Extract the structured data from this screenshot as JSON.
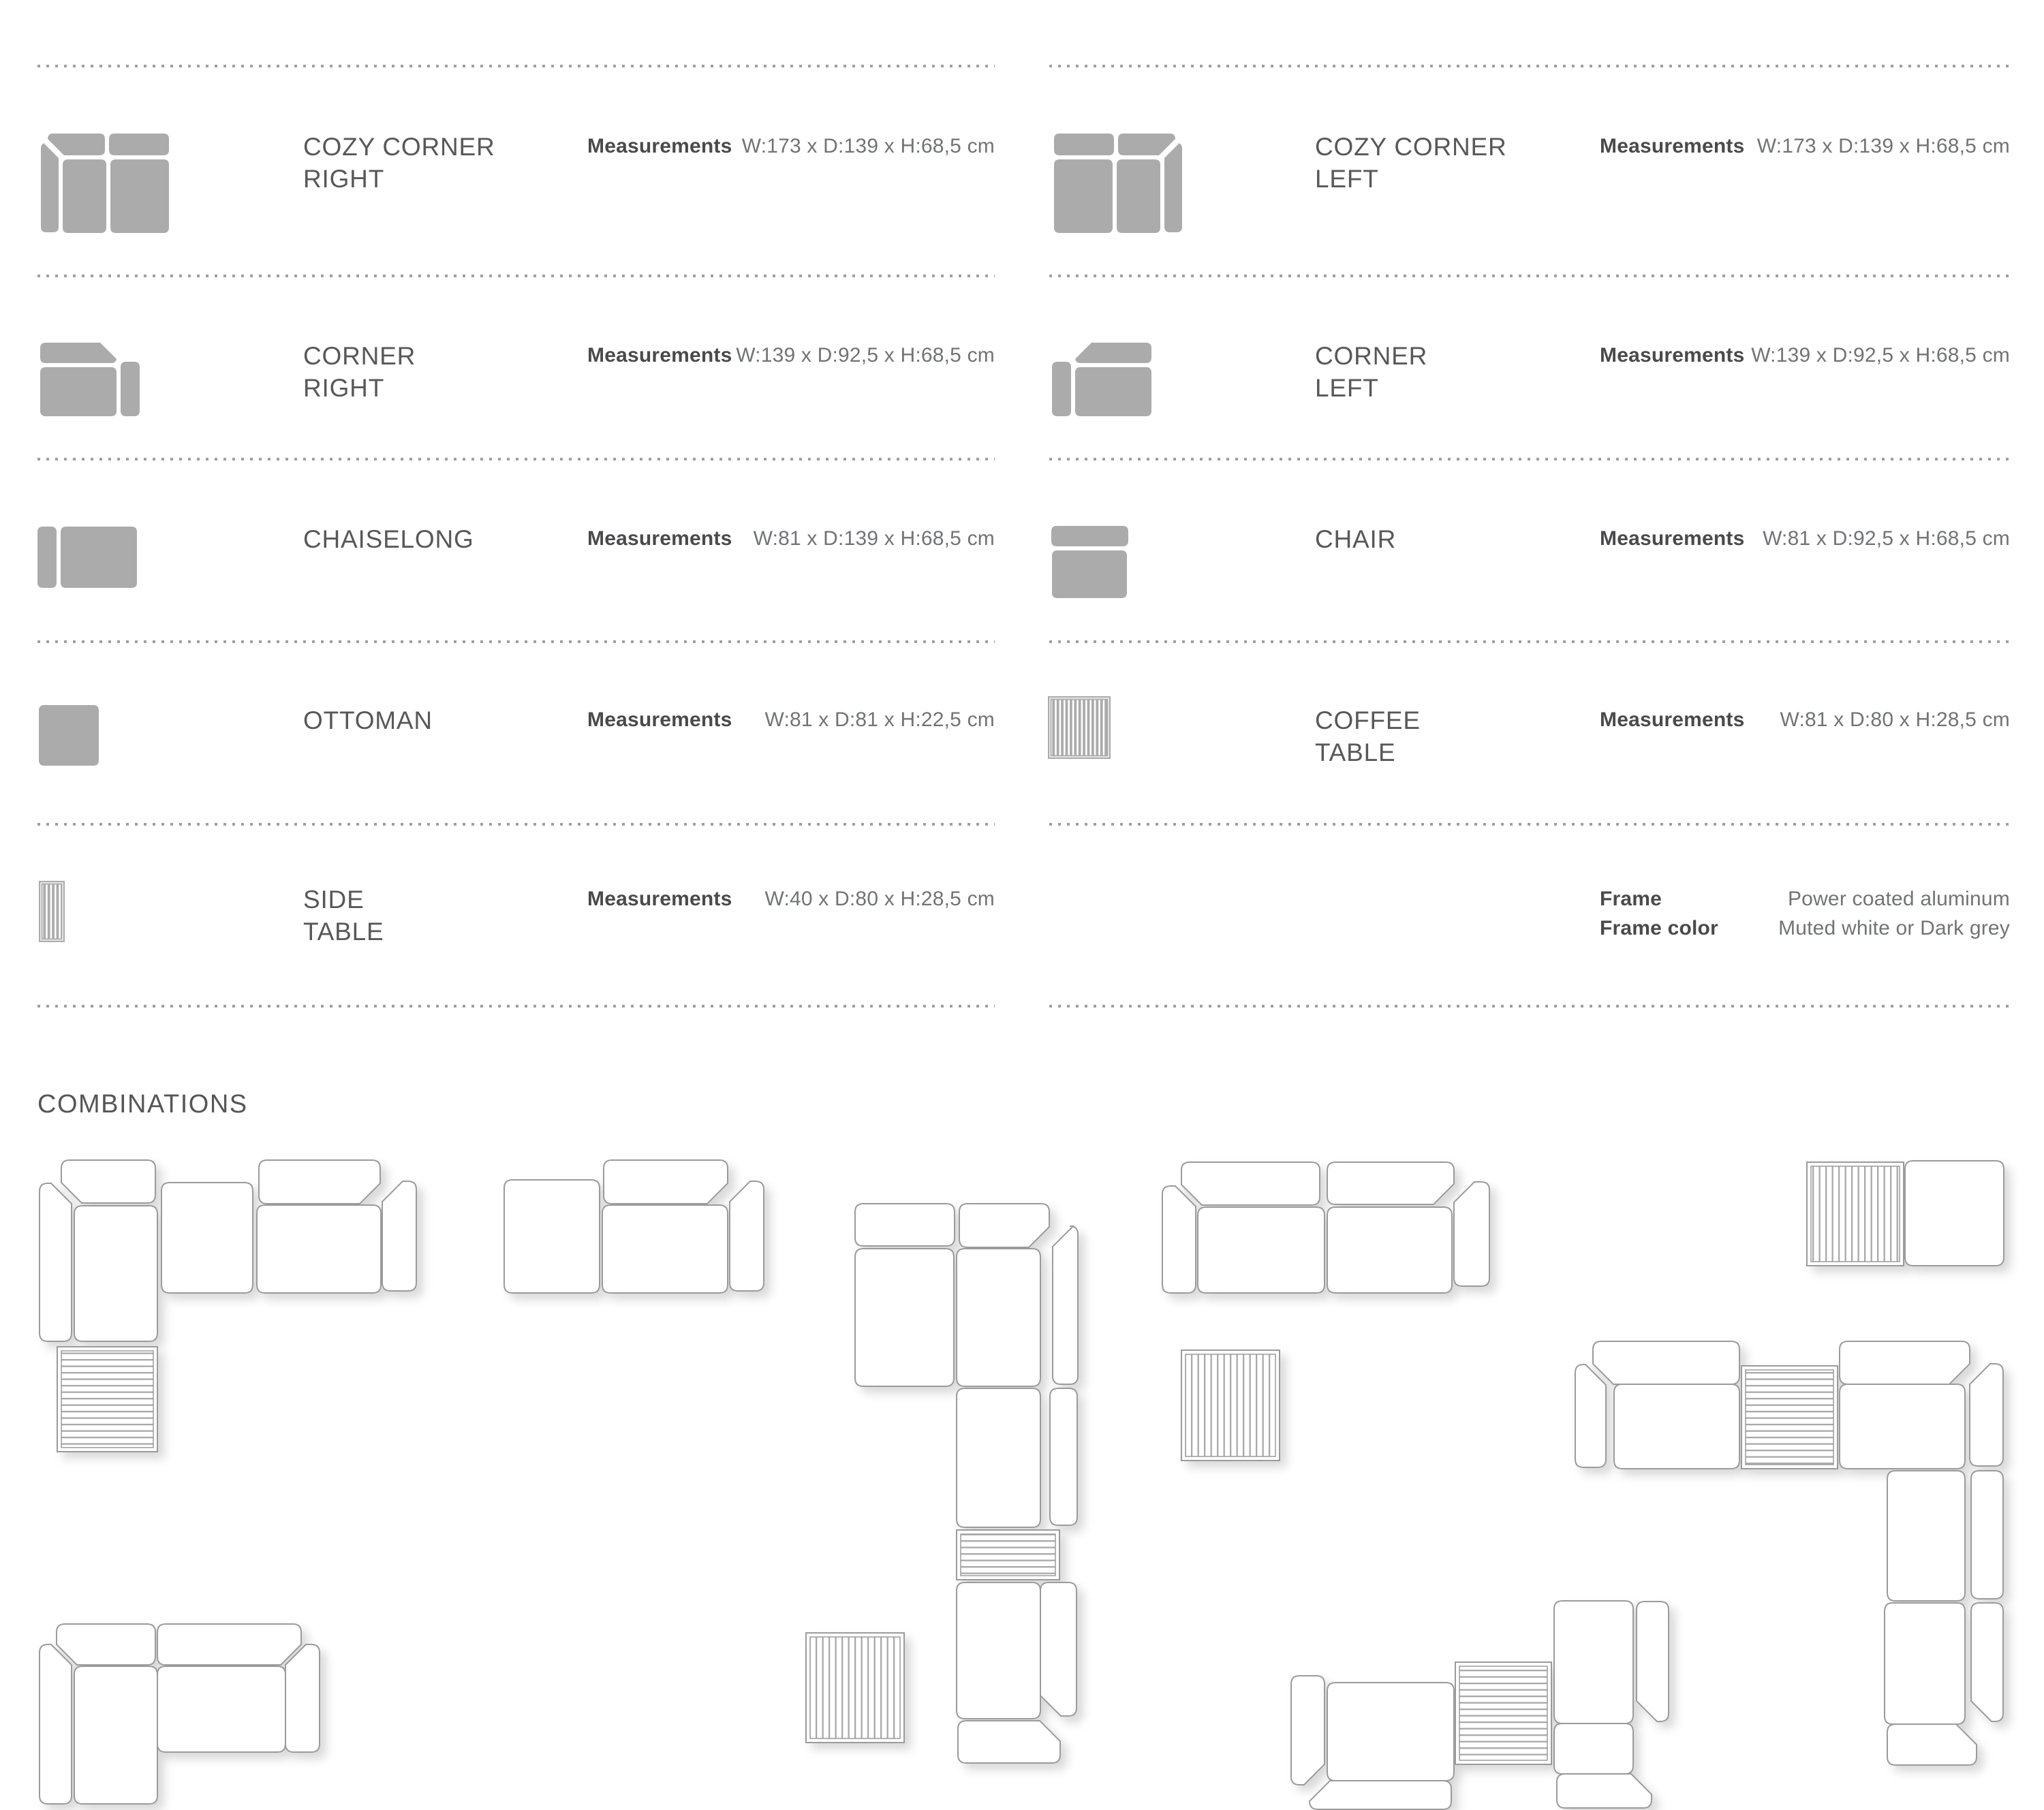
{
  "colors": {
    "background": "#ffffff",
    "icon_gray": "#ababab",
    "outline_stroke": "#9b9b9b",
    "stripe_color": "#a9a9a9",
    "title_text": "#58585a",
    "label_text": "#4a4a4c",
    "value_text": "#727376",
    "dots": "#9f9f9f"
  },
  "products": [
    {
      "id": "cozy-corner-right",
      "column": "left",
      "row": 0,
      "name": "COZY CORNER\nRIGHT",
      "measurements_label": "Measurements",
      "measurements_value": "W:173 x D:139 x H:68,5 cm",
      "icon": "cozy-corner-right-icon"
    },
    {
      "id": "corner-right",
      "column": "left",
      "row": 1,
      "name": "CORNER\nRIGHT",
      "measurements_label": "Measurements",
      "measurements_value": "W:139 x D:92,5 x H:68,5 cm",
      "icon": "corner-right-icon"
    },
    {
      "id": "chaiselong",
      "column": "left",
      "row": 2,
      "name": "CHAISELONG",
      "measurements_label": "Measurements",
      "measurements_value": "W:81 x D:139 x H:68,5 cm",
      "icon": "chaiselong-icon"
    },
    {
      "id": "ottoman",
      "column": "left",
      "row": 3,
      "name": "OTTOMAN",
      "measurements_label": "Measurements",
      "measurements_value": "W:81 x D:81 x H:22,5 cm",
      "icon": "ottoman-icon"
    },
    {
      "id": "side-table",
      "column": "left",
      "row": 4,
      "name": "SIDE\nTABLE",
      "measurements_label": "Measurements",
      "measurements_value": "W:40 x D:80 x H:28,5 cm",
      "icon": "side-table-icon"
    },
    {
      "id": "cozy-corner-left",
      "column": "right",
      "row": 0,
      "name": "COZY CORNER\nLEFT",
      "measurements_label": "Measurements",
      "measurements_value": "W:173 x D:139 x H:68,5 cm",
      "icon": "cozy-corner-left-icon"
    },
    {
      "id": "corner-left",
      "column": "right",
      "row": 1,
      "name": "CORNER\nLEFT",
      "measurements_label": "Measurements",
      "measurements_value": "W:139 x D:92,5 x H:68,5 cm",
      "icon": "corner-left-icon"
    },
    {
      "id": "chair",
      "column": "right",
      "row": 2,
      "name": "CHAIR",
      "measurements_label": "Measurements",
      "measurements_value": "W:81 x D:92,5 x H:68,5 cm",
      "icon": "chair-icon"
    },
    {
      "id": "coffee-table",
      "column": "right",
      "row": 3,
      "name": "COFFEE\nTABLE",
      "measurements_label": "Measurements",
      "measurements_value": "W:81 x D:80 x H:28,5 cm",
      "icon": "coffee-table-icon"
    }
  ],
  "frame_specs": {
    "rows": [
      {
        "label": "Frame",
        "value": "Power coated aluminum"
      },
      {
        "label": "Frame color",
        "value": "Muted white or Dark grey"
      }
    ]
  },
  "combinations": {
    "title": "COMBINATIONS",
    "diagrams": [
      {
        "name": "combination-1",
        "parts": [
          [
            "arm",
            58,
            1737,
            47,
            232,
            "tr"
          ],
          [
            "back",
            90,
            1703,
            138,
            63,
            "bl"
          ],
          [
            "seat",
            109,
            1770,
            122,
            199
          ],
          [
            "seat",
            237,
            1736,
            134,
            162
          ],
          [
            "back",
            380,
            1703,
            178,
            64,
            "br"
          ],
          [
            "seat",
            377,
            1769,
            182,
            129
          ],
          [
            "arm",
            561,
            1734,
            50,
            161,
            "tl"
          ],
          [
            "table",
            84,
            1977,
            147,
            154,
            "h"
          ]
        ]
      },
      {
        "name": "combination-2",
        "parts": [
          [
            "seat",
            740,
            1732,
            140,
            166
          ],
          [
            "back",
            886,
            1703,
            182,
            64,
            "br"
          ],
          [
            "seat",
            884,
            1769,
            184,
            129
          ],
          [
            "arm",
            1071,
            1734,
            50,
            161,
            "tl"
          ]
        ]
      },
      {
        "name": "combination-3",
        "parts": [
          [
            "back",
            1255,
            1767,
            146,
            62,
            ""
          ],
          [
            "back",
            1408,
            1767,
            132,
            64,
            "br"
          ],
          [
            "arm",
            1545,
            1800,
            37,
            232,
            "tl"
          ],
          [
            "seat",
            1255,
            1833,
            145,
            202
          ],
          [
            "seat",
            1404,
            1833,
            123,
            202
          ],
          [
            "seat",
            1404,
            2038,
            123,
            204
          ],
          [
            "arm",
            1541,
            2038,
            40,
            201,
            ""
          ],
          [
            "table",
            1404,
            2246,
            151,
            73,
            "h"
          ],
          [
            "seat",
            1404,
            2323,
            123,
            200
          ],
          [
            "arm",
            1527,
            2323,
            53,
            196,
            "bl"
          ],
          [
            "back",
            1406,
            2526,
            150,
            62,
            "tr"
          ]
        ]
      },
      {
        "name": "combination-4",
        "parts": [
          [
            "arm",
            1706,
            1741,
            49,
            157,
            "tr"
          ],
          [
            "back",
            1734,
            1706,
            203,
            63,
            "bl"
          ],
          [
            "seat",
            1758,
            1772,
            186,
            126
          ],
          [
            "back",
            1948,
            1706,
            186,
            62,
            "br"
          ],
          [
            "seat",
            1948,
            1772,
            183,
            126
          ],
          [
            "arm",
            2134,
            1735,
            52,
            153,
            "tl"
          ],
          [
            "table",
            1734,
            1982,
            144,
            162,
            "v"
          ]
        ]
      },
      {
        "name": "combination-5",
        "parts": [
          [
            "table",
            2652,
            1706,
            142,
            152,
            "v"
          ],
          [
            "seat",
            2796,
            1704,
            145,
            154
          ]
        ]
      },
      {
        "name": "combination-6",
        "parts": [
          [
            "arm",
            2312,
            2003,
            45,
            151,
            "tr"
          ],
          [
            "back",
            2338,
            1969,
            215,
            63,
            "bl"
          ],
          [
            "seat",
            2369,
            2032,
            184,
            124
          ],
          [
            "table",
            2556,
            2005,
            141,
            151,
            "h"
          ],
          [
            "back",
            2700,
            1969,
            191,
            63,
            "br"
          ],
          [
            "seat",
            2700,
            2032,
            184,
            124
          ],
          [
            "arm",
            2891,
            2002,
            49,
            150,
            "tl"
          ],
          [
            "seat",
            2770,
            2159,
            114,
            191
          ],
          [
            "arm",
            2893,
            2159,
            47,
            188,
            ""
          ],
          [
            "seat",
            2766,
            2353,
            118,
            178
          ],
          [
            "arm",
            2893,
            2353,
            47,
            174,
            "bl"
          ],
          [
            "back",
            2770,
            2531,
            131,
            60,
            "tr"
          ]
        ]
      },
      {
        "name": "combination-7",
        "parts": [
          [
            "arm",
            58,
            2414,
            47,
            234,
            "tr"
          ],
          [
            "back",
            83,
            2384,
            145,
            60,
            "bl"
          ],
          [
            "seat",
            109,
            2446,
            122,
            202
          ],
          [
            "back",
            231,
            2384,
            211,
            60,
            "br"
          ],
          [
            "seat",
            231,
            2446,
            188,
            126
          ],
          [
            "arm",
            419,
            2414,
            50,
            158,
            "tl"
          ]
        ]
      },
      {
        "name": "combination-8",
        "parts": [
          [
            "arm",
            1895,
            2460,
            49,
            160,
            "br"
          ],
          [
            "seat",
            1948,
            2470,
            186,
            144
          ],
          [
            "back",
            1922,
            2614,
            208,
            42,
            "tl"
          ],
          [
            "table",
            2136,
            2440,
            141,
            150,
            "h"
          ],
          [
            "seat",
            2281,
            2350,
            116,
            180
          ],
          [
            "arm",
            2402,
            2351,
            47,
            176,
            "bl"
          ],
          [
            "seat",
            2281,
            2530,
            116,
            74
          ],
          [
            "back",
            2285,
            2604,
            139,
            50,
            "tr"
          ]
        ]
      },
      {
        "name": "combination-9",
        "parts": [
          [
            "table",
            1183,
            2397,
            144,
            161,
            "v"
          ]
        ]
      }
    ]
  }
}
